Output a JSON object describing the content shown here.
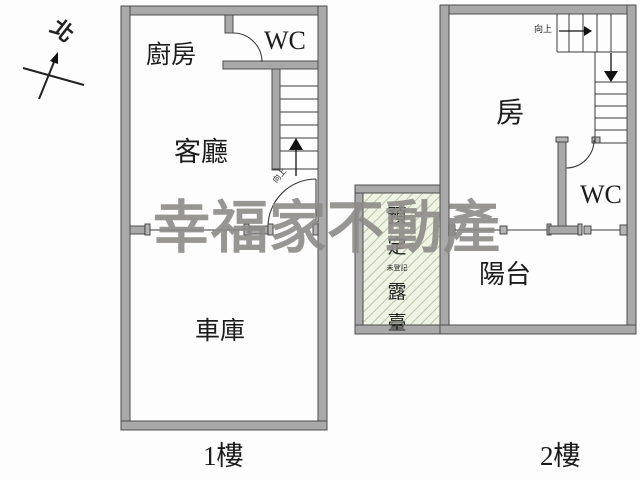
{
  "compass": {
    "label": "北"
  },
  "watermark": {
    "text": "幸福家不動產",
    "color": "#8d8b88"
  },
  "floor1": {
    "label": "1樓",
    "kitchen": "廚房",
    "wc": "WC",
    "living": "客廳",
    "garage": "車庫",
    "stair_note": "向上"
  },
  "floor2": {
    "label": "2樓",
    "room": "房",
    "wc": "WC",
    "balcony": "陽台",
    "stair_note": "向上",
    "terrace": {
      "chars": [
        "預",
        "定",
        "露",
        "臺"
      ],
      "note": "未登記"
    }
  },
  "colors": {
    "wall_fill": "#a9a9a9",
    "wall_stroke": "#4d4d4d",
    "line": "#3a3a3a",
    "hatch_bg": "#eef3e4",
    "watermark": "#8d8b88"
  }
}
